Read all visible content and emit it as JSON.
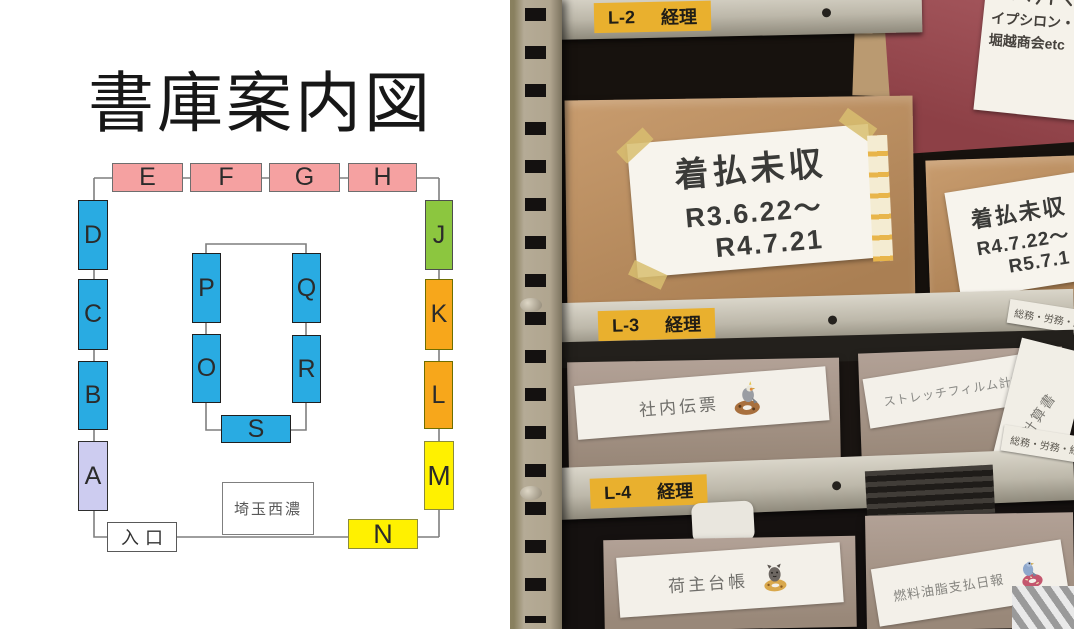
{
  "map": {
    "title": "書庫案内図",
    "entrance_label": "入口",
    "office_label": "埼玉西濃",
    "rooms": {
      "A": "A",
      "B": "B",
      "C": "C",
      "D": "D",
      "E": "E",
      "F": "F",
      "G": "G",
      "H": "H",
      "J": "J",
      "K": "K",
      "L": "L",
      "M": "M",
      "N": "N",
      "O": "O",
      "P": "P",
      "Q": "Q",
      "R": "R",
      "S": "S"
    },
    "colors": {
      "pink": "#f5a1a1",
      "blue": "#29abe2",
      "lavender": "#cdccf0",
      "green": "#8cc63f",
      "orange": "#f7a71b",
      "yellow": "#fff100",
      "connector": "#7f7f7f"
    }
  },
  "shelf_photo": {
    "shelf_tags": [
      {
        "code": "L-2",
        "dept": "経理"
      },
      {
        "code": "L-3",
        "dept": "経理"
      },
      {
        "code": "L-4",
        "dept": "経理"
      }
    ],
    "tag_color": "#e9b02e",
    "handwritten_note_lines": [
      "イプシロン・松",
      "堀越商会etc"
    ],
    "cardboard_box_labels": [
      {
        "title": "着払未収",
        "from": "R3.6.22～",
        "to": "R4.7.21"
      },
      {
        "title": "着払未収",
        "from": "R4.7.22～",
        "to": "R5.7.1"
      }
    ],
    "file_box_labels": [
      "社内伝票",
      "ストレッチフィルム計算書",
      "荷主台帳",
      "燃料油脂支払日報"
    ],
    "side_edge_labels": [
      "総務・労務・経理",
      "総務・労務・経理"
    ],
    "side_sheet_label": "計算書"
  }
}
